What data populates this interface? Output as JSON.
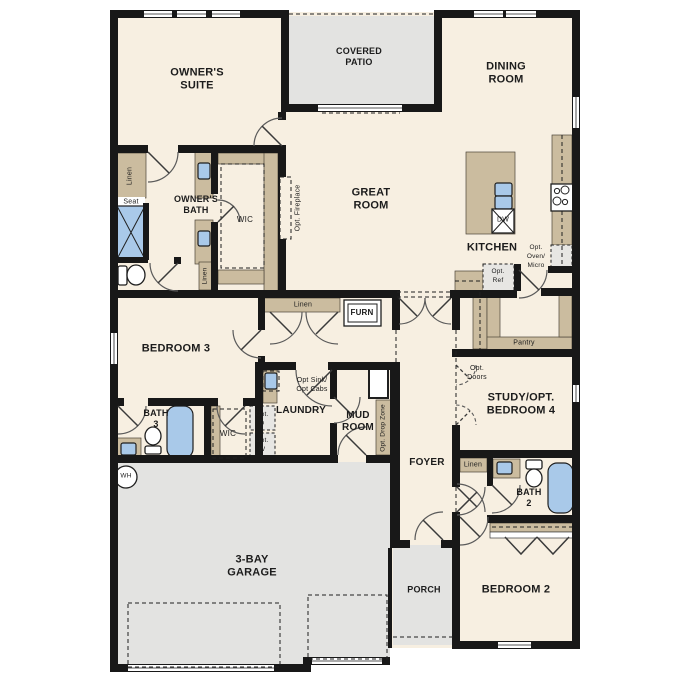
{
  "colors": {
    "wall": "#181818",
    "floor": "#f7efe1",
    "outdoor": "#e3e3e1",
    "cabinet": "#cbbc9f",
    "fixture_blue": "#a9c9e9",
    "appliance_gray": "#e7e6e3"
  },
  "labels": {
    "owners_suite": "OWNER'S\nSUITE",
    "covered_patio": "COVERED\nPATIO",
    "dining_room": "DINING\nROOM",
    "great_room": "GREAT\nROOM",
    "kitchen": "KITCHEN",
    "owners_bath": "OWNER'S\nBATH",
    "wic": "WIC",
    "wic_small": "WIC",
    "opt_fireplace": "Opt. Fireplace",
    "seat": "Seat",
    "linen": "Linen",
    "furn": "FURN",
    "bedroom_3": "BEDROOM 3",
    "bath_3": "BATH\n3",
    "laundry": "LAUNDRY",
    "mud_room": "MUD\nROOM",
    "opt_sink_cabs": "Opt Sink/\nOpt Cabs",
    "opt_d": "Opt.\nD",
    "opt_w": "Opt.\nW",
    "opt_drop_zone": "Opt. Drop Zone",
    "foyer": "FOYER",
    "opt_doors": "Opt.\nDoors",
    "study": "STUDY/OPT.\nBEDROOM 4",
    "bath_2": "BATH\n2",
    "bedroom_2": "BEDROOM 2",
    "porch": "PORCH",
    "garage": "3-BAY\nGARAGE",
    "wh": "WH",
    "dw": "DW",
    "pantry": "Pantry",
    "opt_oven_micro": "Opt.\nOven/\nMicro",
    "opt_ref": "Opt.\nRef"
  }
}
